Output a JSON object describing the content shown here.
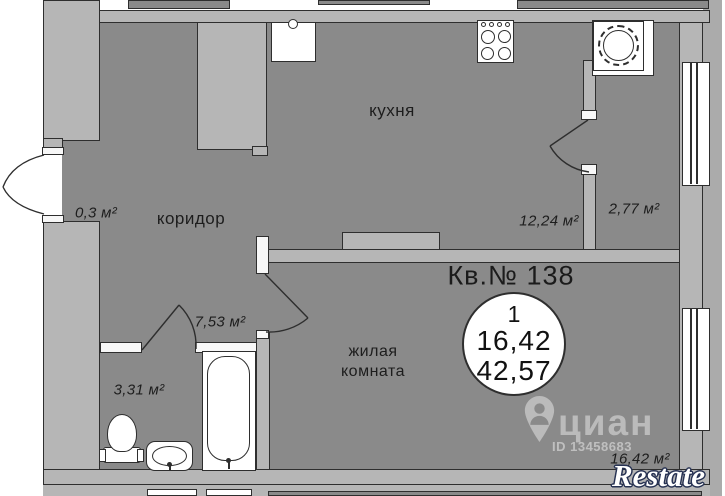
{
  "title": "Кв.№ 138",
  "badge": {
    "rooms_count": "1",
    "living_area": "16,42",
    "total_area": "42,57"
  },
  "rooms": {
    "kitchen": {
      "label": "кухня",
      "area": "12,24 м²"
    },
    "corridor": {
      "label": "коридор",
      "area": "7,53 м²"
    },
    "entry": {
      "area": "0,3 м²"
    },
    "loggia": {
      "area": "2,77 м²"
    },
    "bathroom": {
      "area": "3,31 м²"
    },
    "living_room": {
      "label_line1": "жилая",
      "label_line2": "комната",
      "area": "16,42 м²"
    }
  },
  "watermarks": {
    "cian": {
      "brand": "циан",
      "listing_id": "ID 13458683"
    },
    "restate": {
      "brand": "Restate"
    }
  },
  "icons": [
    "map-pin-person-icon",
    "stove-icon",
    "kitchen-sink-icon",
    "washing-machine-icon",
    "bathtub-icon",
    "toilet-icon",
    "bathroom-sink-icon",
    "wardrobe",
    "window",
    "door-swing-arc"
  ],
  "colors": {
    "room_fill": "#8a8a8a",
    "wall_fill": "#b6b6b6",
    "outline": "#2e2e2e",
    "fixture_fill": "#ffffff",
    "outside_right": "#ababab"
  }
}
